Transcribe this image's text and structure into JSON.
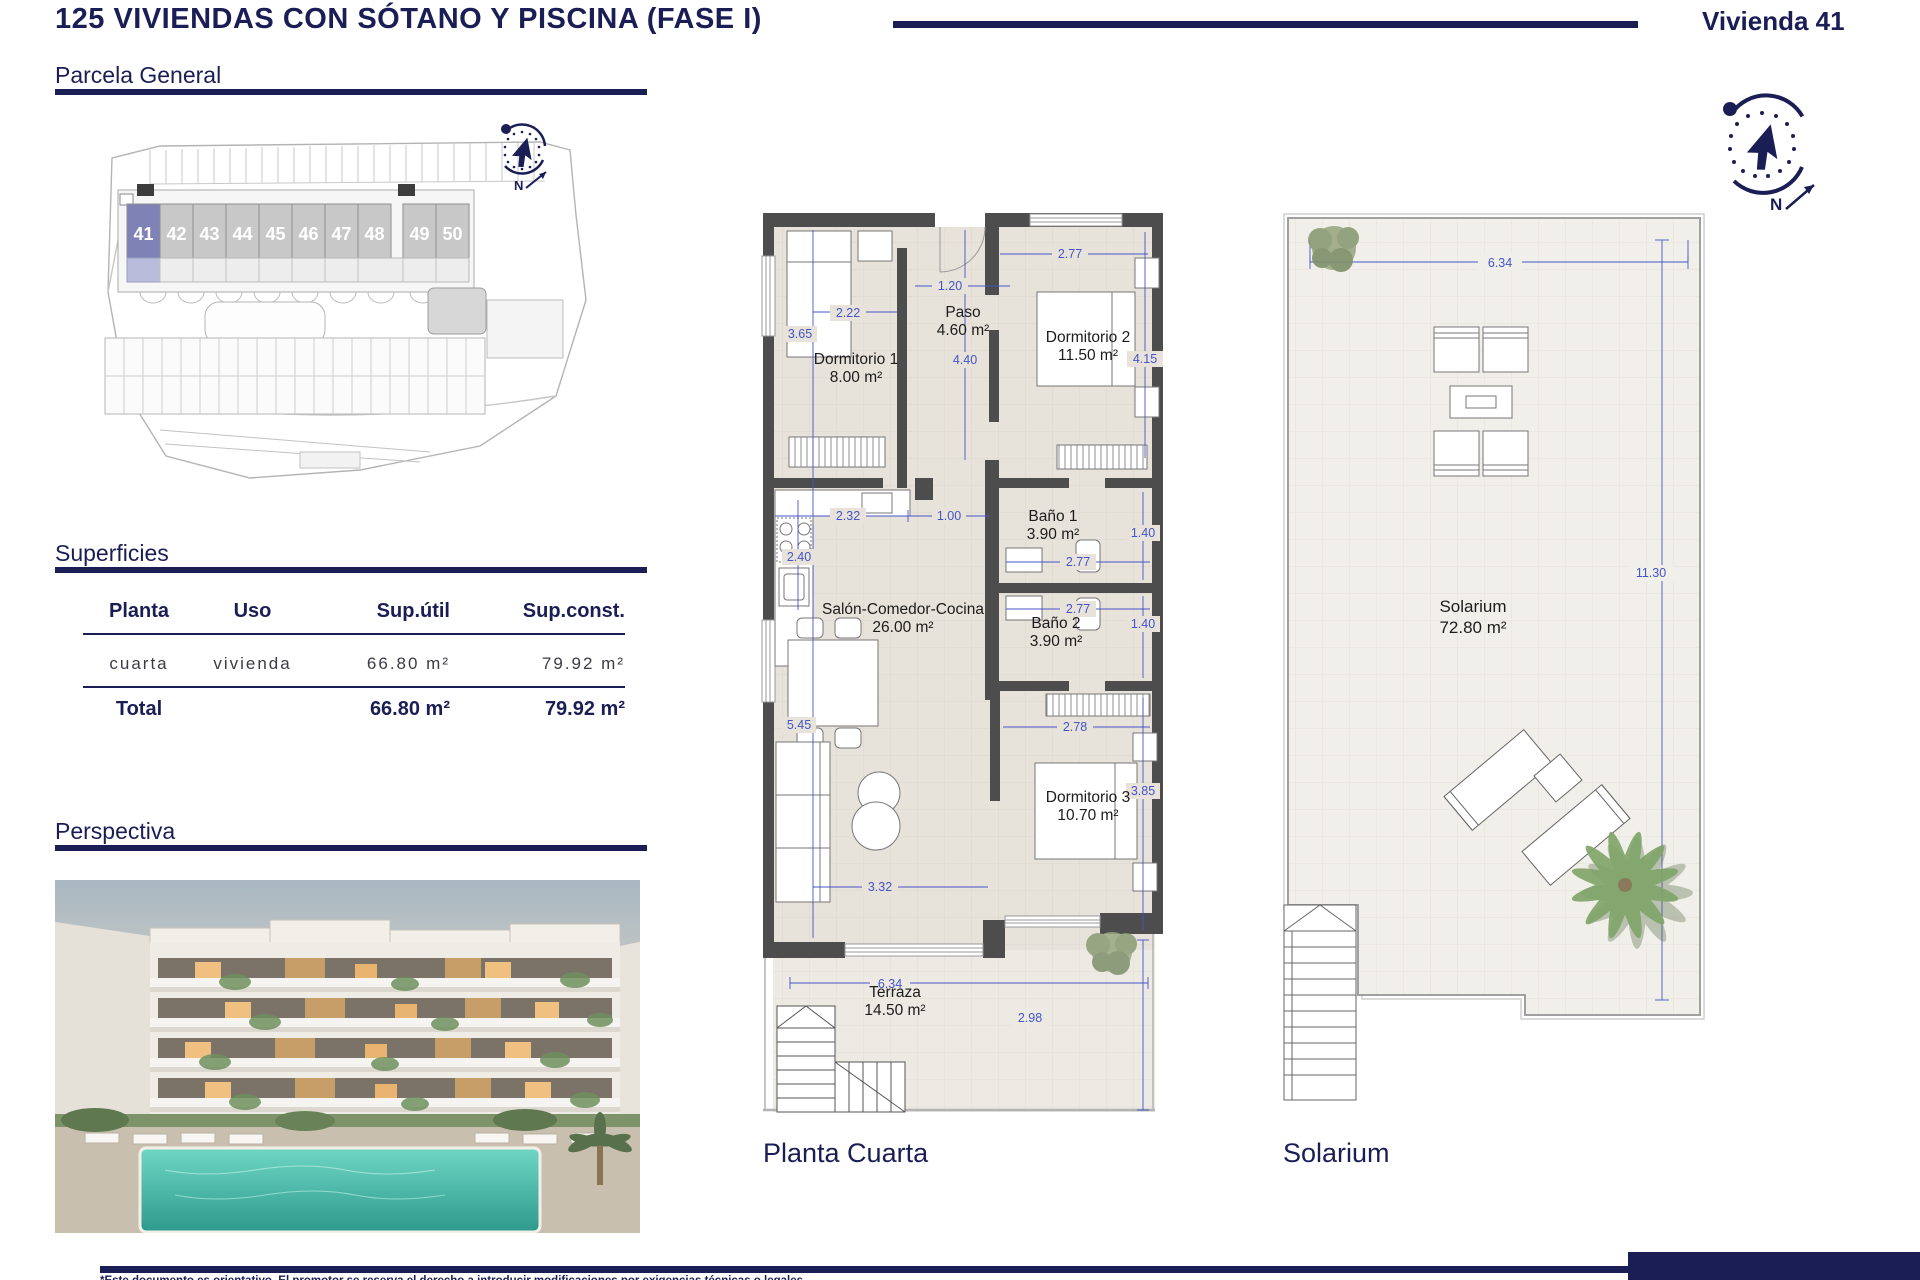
{
  "header": {
    "title": "125 VIVIENDAS CON SÓTANO Y PISCINA (FASE I)",
    "unit_ref": "Vivienda 41"
  },
  "sections": {
    "parcela_title": "Parcela General",
    "superficies_title": "Superficies",
    "perspectiva_title": "Perspectiva"
  },
  "siteplan": {
    "units": [
      "41",
      "42",
      "43",
      "44",
      "45",
      "46",
      "47",
      "48",
      "49",
      "50"
    ],
    "highlighted_unit": "41"
  },
  "compass": {
    "north_label": "N"
  },
  "surfaces_table": {
    "headers": [
      "Planta",
      "Uso",
      "Sup.útil",
      "Sup.const."
    ],
    "row": {
      "planta": "cuarta",
      "uso": "vivienda",
      "sup_util": "66.80 m²",
      "sup_const": "79.92 m²"
    },
    "total": {
      "label": "Total",
      "sup_util": "66.80 m²",
      "sup_const": "79.92 m²"
    }
  },
  "floorplan": {
    "caption": "Planta Cuarta",
    "rooms": {
      "dorm1": {
        "name": "Dormitorio 1",
        "area": "8.00 m²"
      },
      "paso": {
        "name": "Paso",
        "area": "4.60 m²"
      },
      "dorm2": {
        "name": "Dormitorio 2",
        "area": "11.50 m²"
      },
      "bano1": {
        "name": "Baño 1",
        "area": "3.90 m²"
      },
      "bano2": {
        "name": "Baño 2",
        "area": "3.90 m²"
      },
      "salon": {
        "name": "Salón-Comedor-Cocina",
        "area": "26.00 m²"
      },
      "dorm3": {
        "name": "Dormitorio 3",
        "area": "10.70 m²"
      },
      "terraza": {
        "name": "Terraza",
        "area": "14.50 m²"
      }
    },
    "dims": {
      "dorm1_h": "3.65",
      "dorm1_w": "2.22",
      "entrada": "1.20",
      "paso_h": "4.40",
      "dorm2_w": "2.77",
      "dorm2_h": "4.15",
      "cocina_w": "2.32",
      "puerta": "1.00",
      "cocina_h": "2.40",
      "bano1_h": "1.40",
      "bano1_w": "2.77",
      "bano2_w": "2.77",
      "bano2_h": "1.40",
      "salon_h": "5.45",
      "dorm3_w": "2.78",
      "dorm3_h": "3.85",
      "salon_w": "3.32",
      "terraza_w": "6.34",
      "terraza_h": "2.98"
    }
  },
  "solarium_plan": {
    "caption": "Solarium",
    "room": {
      "name": "Solarium",
      "area": "72.80 m²"
    },
    "dims": {
      "w": "6.34",
      "h": "11.30"
    }
  },
  "footer": {
    "note": "*Este documento es orientativo. El promotor se reserva el derecho a introducir modificaciones por exigencias técnicas o legales."
  },
  "colors": {
    "navy": "#1a1e55",
    "dim_blue": "#4554c8",
    "highlight_purple": "#7e82b7",
    "unit_gray": "#c8c8c8"
  }
}
